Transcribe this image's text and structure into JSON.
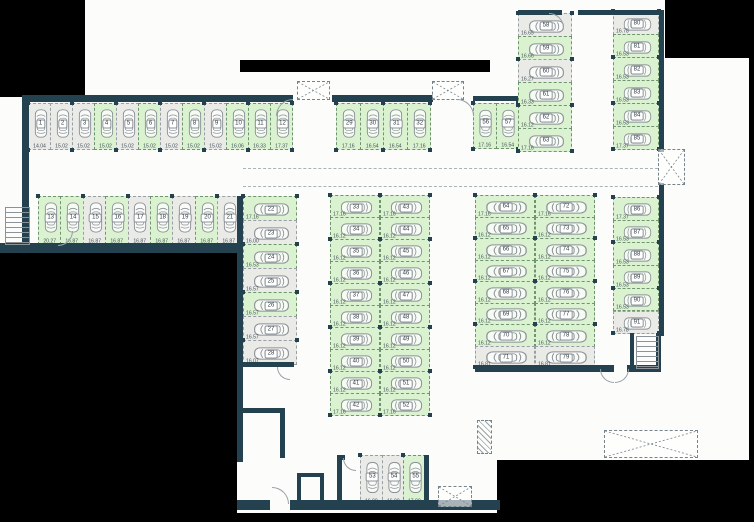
{
  "meta": {
    "background_color": "#000000",
    "floor_color": "#fcfcfa",
    "wall_color": "#24414f",
    "available_fill": "#daf2cf",
    "occupied_fill": "#eaeae7",
    "legend": {
      "green": "available-space",
      "gray": "occupied-space"
    }
  },
  "groups": [
    {
      "id": "top-row",
      "dir": "row",
      "x": 28,
      "y": 103,
      "stall": 22,
      "depth": 47,
      "rot": -90,
      "spaces": [
        {
          "n": "1",
          "a": "14.04",
          "s": "occupied"
        },
        {
          "n": "2",
          "a": "15.02",
          "s": "occupied"
        },
        {
          "n": "3",
          "a": "15.02",
          "s": "occupied"
        },
        {
          "n": "4",
          "a": "15.02",
          "s": "available"
        },
        {
          "n": "5",
          "a": "15.02",
          "s": "occupied"
        },
        {
          "n": "6",
          "a": "15.02",
          "s": "available"
        },
        {
          "n": "7",
          "a": "15.02",
          "s": "occupied"
        },
        {
          "n": "8",
          "a": "15.02",
          "s": "available"
        },
        {
          "n": "9",
          "a": "15.02",
          "s": "occupied"
        },
        {
          "n": "10",
          "a": "16.06",
          "s": "available"
        },
        {
          "n": "11",
          "a": "16.33",
          "s": "available"
        },
        {
          "n": "12",
          "a": "17.37",
          "s": "available"
        }
      ]
    },
    {
      "id": "second-row",
      "dir": "row",
      "x": 38,
      "y": 196,
      "stall": 22.4,
      "depth": 49,
      "rot": -90,
      "spaces": [
        {
          "n": "13",
          "a": "20.27",
          "s": "available"
        },
        {
          "n": "14",
          "a": "16.87",
          "s": "available"
        },
        {
          "n": "15",
          "a": "16.87",
          "s": "occupied"
        },
        {
          "n": "16",
          "a": "16.87",
          "s": "available"
        },
        {
          "n": "17",
          "a": "16.87",
          "s": "occupied"
        },
        {
          "n": "18",
          "a": "16.87",
          "s": "available"
        },
        {
          "n": "19",
          "a": "16.87",
          "s": "occupied"
        },
        {
          "n": "20",
          "a": "16.87",
          "s": "available"
        },
        {
          "n": "21",
          "a": "16.87",
          "s": "occupied"
        }
      ]
    },
    {
      "id": "mid-top-row",
      "dir": "row",
      "x": 336,
      "y": 103,
      "stall": 23.5,
      "depth": 47,
      "rot": -90,
      "spaces": [
        {
          "n": "29",
          "a": "17.16",
          "s": "available"
        },
        {
          "n": "30",
          "a": "16.54",
          "s": "available"
        },
        {
          "n": "31",
          "a": "16.54",
          "s": "available"
        },
        {
          "n": "32",
          "a": "17.16",
          "s": "available"
        }
      ]
    },
    {
      "id": "bend-row",
      "dir": "row",
      "x": 473,
      "y": 103,
      "stall": 22.5,
      "depth": 46,
      "rot": -90,
      "spaces": [
        {
          "n": "56",
          "a": "17.16",
          "s": "available"
        },
        {
          "n": "57",
          "a": "16.54",
          "s": "available"
        }
      ]
    },
    {
      "id": "left-column",
      "dir": "col",
      "x": 243,
      "y": 196,
      "stall": 24,
      "depth": 54,
      "rot": 180,
      "spaces": [
        {
          "n": "22",
          "a": "17.16",
          "s": "available"
        },
        {
          "n": "23",
          "a": "16.00",
          "s": "occupied"
        },
        {
          "n": "24",
          "a": "16.53",
          "s": "available"
        },
        {
          "n": "25",
          "a": "16.57",
          "s": "occupied"
        },
        {
          "n": "26",
          "a": "16.57",
          "s": "available"
        },
        {
          "n": "27",
          "a": "16.57",
          "s": "occupied"
        },
        {
          "n": "28",
          "a": "16.07",
          "s": "occupied"
        }
      ]
    },
    {
      "id": "center-col-left",
      "dir": "col",
      "x": 330,
      "y": 195,
      "stall": 22,
      "depth": 50,
      "rot": 180,
      "spaces": [
        {
          "n": "33",
          "a": "17.16",
          "s": "available"
        },
        {
          "n": "34",
          "a": "16.12",
          "s": "available"
        },
        {
          "n": "35",
          "a": "16.12",
          "s": "available"
        },
        {
          "n": "36",
          "a": "16.12",
          "s": "available"
        },
        {
          "n": "37",
          "a": "16.12",
          "s": "available"
        },
        {
          "n": "38",
          "a": "16.12",
          "s": "available"
        },
        {
          "n": "39",
          "a": "16.12",
          "s": "available"
        },
        {
          "n": "40",
          "a": "16.12",
          "s": "available"
        },
        {
          "n": "41",
          "a": "16.12",
          "s": "available"
        },
        {
          "n": "42",
          "a": "17.16",
          "s": "available"
        }
      ]
    },
    {
      "id": "center-col-right",
      "dir": "col",
      "x": 380,
      "y": 195,
      "stall": 22,
      "depth": 50,
      "rot": 0,
      "spaces": [
        {
          "n": "43",
          "a": "17.16",
          "s": "available"
        },
        {
          "n": "44",
          "a": "16.12",
          "s": "available"
        },
        {
          "n": "45",
          "a": "16.12",
          "s": "available"
        },
        {
          "n": "46",
          "a": "16.12",
          "s": "available"
        },
        {
          "n": "47",
          "a": "16.12",
          "s": "available"
        },
        {
          "n": "48",
          "a": "16.12",
          "s": "available"
        },
        {
          "n": "49",
          "a": "16.12",
          "s": "available"
        },
        {
          "n": "50",
          "a": "16.12",
          "s": "available"
        },
        {
          "n": "51",
          "a": "16.12",
          "s": "available"
        },
        {
          "n": "52",
          "a": "17.16",
          "s": "available"
        }
      ]
    },
    {
      "id": "right-col-left",
      "dir": "col",
      "x": 475,
      "y": 195,
      "stall": 21.5,
      "depth": 60,
      "rot": 180,
      "spaces": [
        {
          "n": "64",
          "a": "17.16",
          "s": "available"
        },
        {
          "n": "65",
          "a": "16.12",
          "s": "available"
        },
        {
          "n": "66",
          "a": "16.12",
          "s": "available"
        },
        {
          "n": "67",
          "a": "16.12",
          "s": "available"
        },
        {
          "n": "68",
          "a": "16.12",
          "s": "available"
        },
        {
          "n": "69",
          "a": "16.12",
          "s": "available"
        },
        {
          "n": "70",
          "a": "16.12",
          "s": "available"
        },
        {
          "n": "71",
          "a": "16.81",
          "s": "occupied"
        }
      ]
    },
    {
      "id": "right-col-right",
      "dir": "col",
      "x": 535,
      "y": 195,
      "stall": 21.5,
      "depth": 60,
      "rot": 0,
      "spaces": [
        {
          "n": "72",
          "a": "17.16",
          "s": "available"
        },
        {
          "n": "73",
          "a": "16.12",
          "s": "available"
        },
        {
          "n": "74",
          "a": "16.12",
          "s": "available"
        },
        {
          "n": "75",
          "a": "16.12",
          "s": "available"
        },
        {
          "n": "76",
          "a": "16.12",
          "s": "available"
        },
        {
          "n": "77",
          "a": "16.12",
          "s": "available"
        },
        {
          "n": "78",
          "a": "16.12",
          "s": "available"
        },
        {
          "n": "79",
          "a": "16.81",
          "s": "occupied"
        }
      ]
    },
    {
      "id": "topright-col-left",
      "dir": "col",
      "x": 518,
      "y": 13,
      "stall": 23,
      "depth": 54,
      "rot": 180,
      "spaces": [
        {
          "n": "58",
          "a": "16.65",
          "s": "occupied"
        },
        {
          "n": "59",
          "a": "16.66",
          "s": "available"
        },
        {
          "n": "60",
          "a": "16.27",
          "s": "occupied"
        },
        {
          "n": "61",
          "a": "16.33",
          "s": "available"
        },
        {
          "n": "62",
          "a": "16.12",
          "s": "available"
        },
        {
          "n": "63",
          "a": "17.16",
          "s": "available"
        }
      ]
    },
    {
      "id": "topright-col-right",
      "dir": "col",
      "x": 613,
      "y": 11,
      "stall": 23,
      "depth": 46,
      "rot": 0,
      "spaces": [
        {
          "n": "80",
          "a": "16.78",
          "s": "occupied"
        },
        {
          "n": "81",
          "a": "16.53",
          "s": "available"
        },
        {
          "n": "82",
          "a": "16.53",
          "s": "available"
        },
        {
          "n": "83",
          "a": "16.53",
          "s": "available"
        },
        {
          "n": "84",
          "a": "16.53",
          "s": "available"
        },
        {
          "n": "85",
          "a": "17.37",
          "s": "available"
        }
      ]
    },
    {
      "id": "farright-col",
      "dir": "col",
      "x": 613,
      "y": 197,
      "stall": 22.7,
      "depth": 46,
      "rot": 0,
      "spaces": [
        {
          "n": "86",
          "a": "17.37",
          "s": "available"
        },
        {
          "n": "87",
          "a": "16.53",
          "s": "available"
        },
        {
          "n": "88",
          "a": "16.53",
          "s": "available"
        },
        {
          "n": "89",
          "a": "16.53",
          "s": "available"
        },
        {
          "n": "90",
          "a": "16.53",
          "s": "available"
        },
        {
          "n": "91",
          "a": "16.78",
          "s": "occupied"
        }
      ]
    },
    {
      "id": "bottom-row",
      "dir": "row",
      "x": 360,
      "y": 455,
      "stall": 21.7,
      "depth": 50,
      "rot": -90,
      "spaces": [
        {
          "n": "53",
          "a": "16.00",
          "s": "occupied"
        },
        {
          "n": "54",
          "a": "16.00",
          "s": "occupied"
        },
        {
          "n": "55",
          "a": "17.00",
          "s": "available"
        }
      ]
    }
  ],
  "walls": [
    [
      22,
      95,
      271,
      7
    ],
    [
      332,
      95,
      101,
      7
    ],
    [
      473,
      96,
      45,
      5
    ],
    [
      22,
      95,
      7,
      150
    ],
    [
      0,
      243,
      241,
      10
    ],
    [
      237,
      196,
      6,
      266
    ],
    [
      518,
      10,
      44,
      5
    ],
    [
      578,
      10,
      86,
      5
    ],
    [
      659,
      12,
      5,
      140
    ],
    [
      659,
      183,
      5,
      153
    ],
    [
      630,
      333,
      4,
      39
    ],
    [
      656,
      333,
      5,
      39
    ],
    [
      630,
      367,
      31,
      5
    ],
    [
      475,
      365,
      139,
      7
    ],
    [
      627,
      365,
      33,
      7
    ],
    [
      237,
      362,
      57,
      5
    ],
    [
      237,
      408,
      48,
      5
    ],
    [
      280,
      408,
      5,
      50
    ],
    [
      297,
      473,
      27,
      4
    ],
    [
      297,
      473,
      4,
      34
    ],
    [
      320,
      473,
      4,
      34
    ],
    [
      337,
      455,
      8,
      5
    ],
    [
      337,
      460,
      5,
      45
    ],
    [
      424,
      455,
      5,
      50
    ],
    [
      237,
      500,
      33,
      10
    ],
    [
      290,
      500,
      210,
      10
    ]
  ],
  "black_regions": [
    [
      0,
      0,
      85,
      97
    ],
    [
      240,
      60,
      250,
      12
    ],
    [
      665,
      0,
      89,
      58
    ],
    [
      749,
      58,
      5,
      404
    ],
    [
      0,
      253,
      237,
      269
    ],
    [
      497,
      460,
      257,
      62
    ],
    [
      0,
      513,
      754,
      9
    ]
  ],
  "dash_lines": [
    {
      "x": 243,
      "y": 168,
      "len": 415
    },
    {
      "x": 243,
      "y": 186,
      "len": 415
    }
  ],
  "xboxes": [
    [
      297,
      81,
      31,
      17
    ],
    [
      432,
      81,
      30,
      17
    ],
    [
      658,
      149,
      25,
      34
    ],
    [
      438,
      486,
      32,
      19
    ],
    [
      604,
      430,
      92,
      26
    ]
  ],
  "hatches": [
    [
      477,
      420,
      13,
      32
    ]
  ],
  "arcs": [
    {
      "x": 276,
      "y": 99,
      "r": 16,
      "c": "tl"
    },
    {
      "x": 457,
      "y": 99,
      "r": 16,
      "c": "tr"
    },
    {
      "x": 549,
      "y": 13,
      "r": 14,
      "c": "tr"
    },
    {
      "x": 58,
      "y": 231,
      "r": 14,
      "c": "br"
    },
    {
      "x": 277,
      "y": 367,
      "r": 12,
      "c": "bl"
    },
    {
      "x": 600,
      "y": 369,
      "r": 13,
      "c": "bl"
    },
    {
      "x": 615,
      "y": 369,
      "r": 13,
      "c": "br"
    },
    {
      "x": 272,
      "y": 487,
      "r": 16,
      "c": "tr"
    },
    {
      "x": 343,
      "y": 458,
      "r": 12,
      "c": "bl"
    }
  ],
  "stairs": [
    {
      "x": 5,
      "y": 207,
      "w": 23,
      "h": 36
    },
    {
      "x": 636,
      "y": 336,
      "w": 21,
      "h": 31
    }
  ]
}
